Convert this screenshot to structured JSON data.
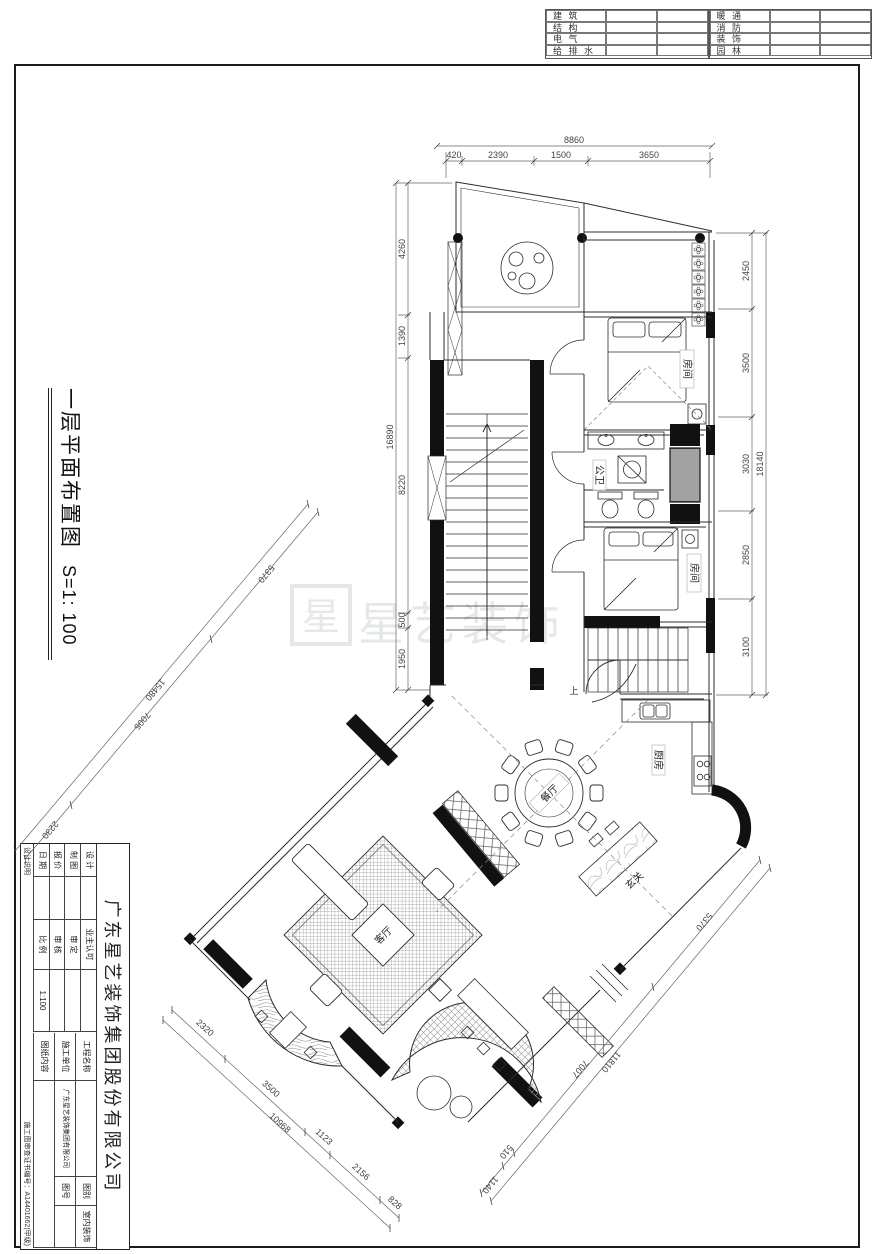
{
  "header_table": {
    "left_rows": [
      "建 筑",
      "结 构",
      "电 气",
      "给 排 水"
    ],
    "right_rows": [
      "暖 通",
      "消 防",
      "装 饰",
      "园 林"
    ]
  },
  "sheet": {
    "title": "一层平面布置图",
    "scale": "S=1: 100"
  },
  "title_block": {
    "company": "广东星艺装饰集团股份有限公司",
    "design": "设 计",
    "draft": "制 图",
    "quote": "报 价",
    "date": "日 期",
    "owner_approval": "业主认可",
    "approved": "审 定",
    "checked": "审 核",
    "scale_label": "比 例",
    "scale_value": "1:100",
    "project_name": "工程名称",
    "construction_unit": "施工单位",
    "construction_unit_value": "广东星艺装饰集团有限公司",
    "drawing_content": "图纸内容",
    "category_label": "图别",
    "category_value": "室内装饰",
    "number_label": "图号",
    "design_note": "设计说明",
    "certificate": "施工图审查证书编号：A14401662(甲级)"
  },
  "watermark": {
    "logo_char": "星",
    "text": "星艺装饰"
  },
  "plan": {
    "labels": {
      "bedroom1": "房间",
      "bath": "公卫",
      "bedroom2": "房间",
      "kitchen": "厨房",
      "dining": "餐厅",
      "foyer": "玄关",
      "living": "客厅",
      "stair_up": "上"
    },
    "dims": {
      "top": {
        "total": "8860",
        "segments": [
          "420",
          "2390",
          "1500",
          "3650"
        ]
      },
      "right": {
        "total": "18140",
        "segments": [
          "2450",
          "3500",
          "3030",
          "2850",
          "3100"
        ]
      },
      "left": {
        "total": "16890",
        "segments": [
          "4260",
          "1390",
          "8220",
          "500",
          "1950"
        ]
      },
      "left_diagonal": {
        "total": "15480",
        "segments": [
          "5370",
          "7005",
          "2230"
        ]
      },
      "bottom_left_diagonal": {
        "total": "10968",
        "segments": [
          "2320",
          "3500",
          "1123",
          "2156",
          "828"
        ]
      },
      "bottom_right_diagonal": {
        "total": "11810",
        "segments": [
          "5370",
          "7007",
          "510",
          "1140"
        ]
      }
    }
  }
}
